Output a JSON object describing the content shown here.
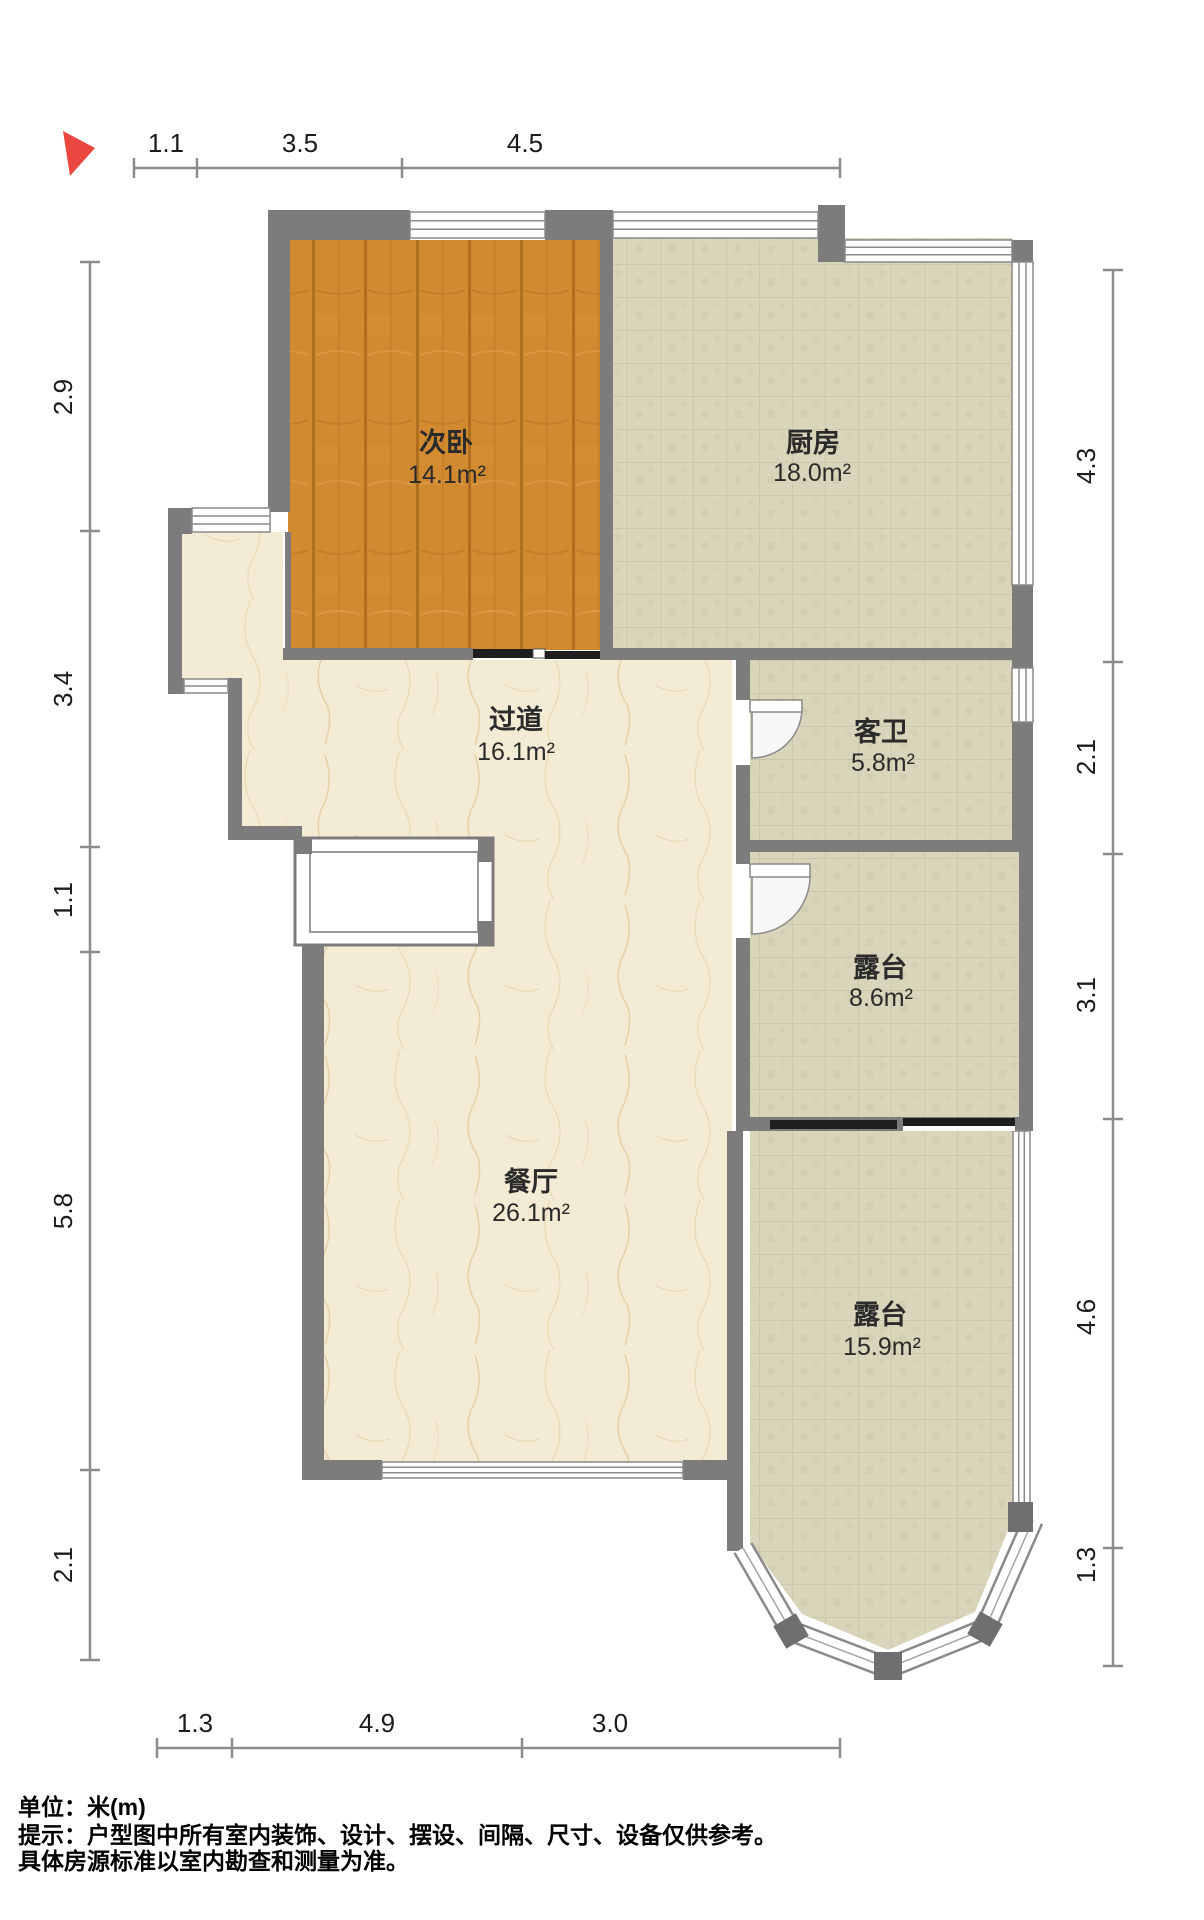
{
  "compass": {
    "direction_icon": "north-arrow",
    "color": "#ea4741"
  },
  "rooms": [
    {
      "name": "次卧",
      "area": "14.1m²"
    },
    {
      "name": "厨房",
      "area": "18.0m²"
    },
    {
      "name": "过道",
      "area": "16.1m²"
    },
    {
      "name": "客卫",
      "area": "5.8m²"
    },
    {
      "name": "露台",
      "area": "8.6m²"
    },
    {
      "name": "餐厅",
      "area": "26.1m²"
    },
    {
      "name": "露台",
      "area": "15.9m²"
    }
  ],
  "dimensions": {
    "top": [
      "1.1",
      "3.5",
      "4.5"
    ],
    "bottom": [
      "1.3",
      "4.9",
      "3.0"
    ],
    "left": [
      "2.9",
      "3.4",
      "1.1",
      "5.8",
      "2.1"
    ],
    "right": [
      "4.3",
      "2.1",
      "3.1",
      "4.6",
      "1.3"
    ]
  },
  "footer": {
    "line1": "单位：米(m)",
    "line2": "提示：户型图中所有室内装饰、设计、摆设、间隔、尺寸、设备仅供参考。",
    "line3": "具体房源标准以室内勘查和测量为准。"
  },
  "colors": {
    "wall": "#7c7c7c",
    "wall_dark": "#6f6f6f",
    "wood_floor": "#d18a2f",
    "tile_floor": "#d8d5ba",
    "marble_floor": "#f4ebd5",
    "window_fill": "#ffffff",
    "dimension_line": "#8c8c8c",
    "sliding_door": "#1e1e1e",
    "compass": "#ea4741"
  }
}
